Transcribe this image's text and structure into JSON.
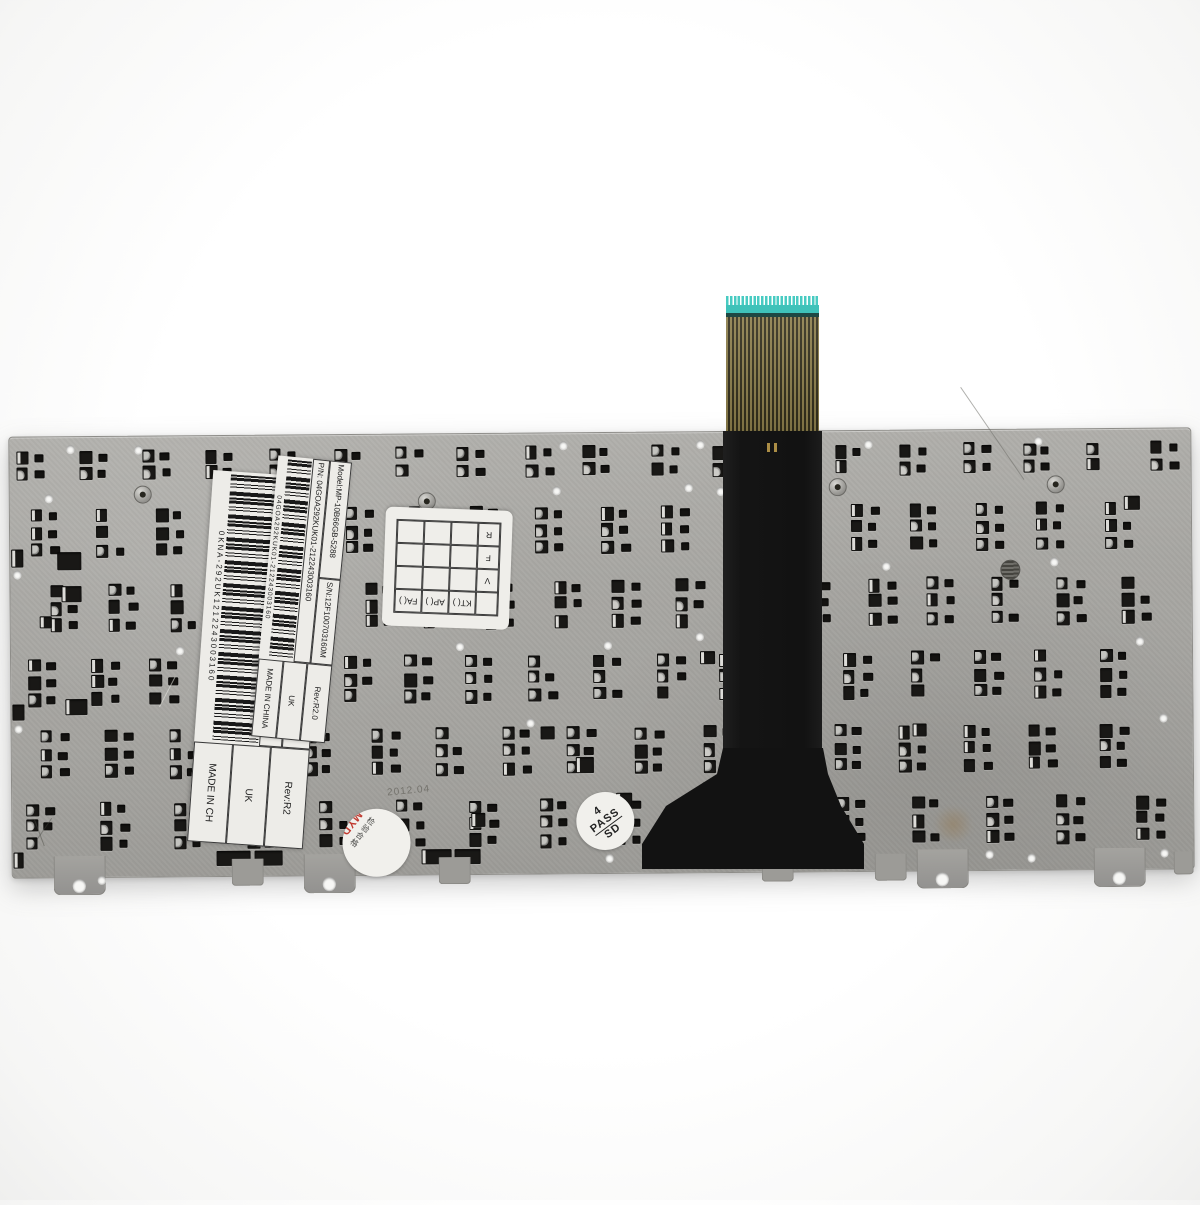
{
  "product": {
    "description": "Rear view of a laptop replacement keyboard: metal backplate with clip cutouts and flex ribbon cable"
  },
  "labels": {
    "large": {
      "model": "Model:MP-10B66GB-5288",
      "sn": "S/N:12F100703160M",
      "pn_prefix": "P/N:",
      "pn": "0KNA-292UK1212243003160",
      "rev": "Rev:R2",
      "country": "UK",
      "made_in": "MADE IN CH"
    },
    "small": {
      "model": "Model:MP-10B66GB-5288",
      "sn": "S/N:12F100703160M",
      "pn_prefix": "P/N:",
      "pn": "04GOA292KUK01-212243003160",
      "rev": "Rev:R2.0",
      "country": "UK",
      "made_in": "MADE IN CHINA"
    }
  },
  "grid_stamp": {
    "col1": "KT( )",
    "col2": "AP( )",
    "col3": "FA( )",
    "row1": "V",
    "row2": "F",
    "row3": "R"
  },
  "date_stamp": {
    "number": "201",
    "date_units": "年月日",
    "code": "MYD",
    "code_color": "#c03a30",
    "side_text": "检验合格"
  },
  "pass_stamp": {
    "digit": "4",
    "word": "PASS",
    "code": "SD"
  },
  "etched_text": "2012.04",
  "colors": {
    "plate": "#a7a6a2",
    "slot": "#191816",
    "cable_tip": "#3fc2b9",
    "cable_film": "#8b7d4a",
    "cable_black": "#131313",
    "label_bg": "#edece8"
  }
}
